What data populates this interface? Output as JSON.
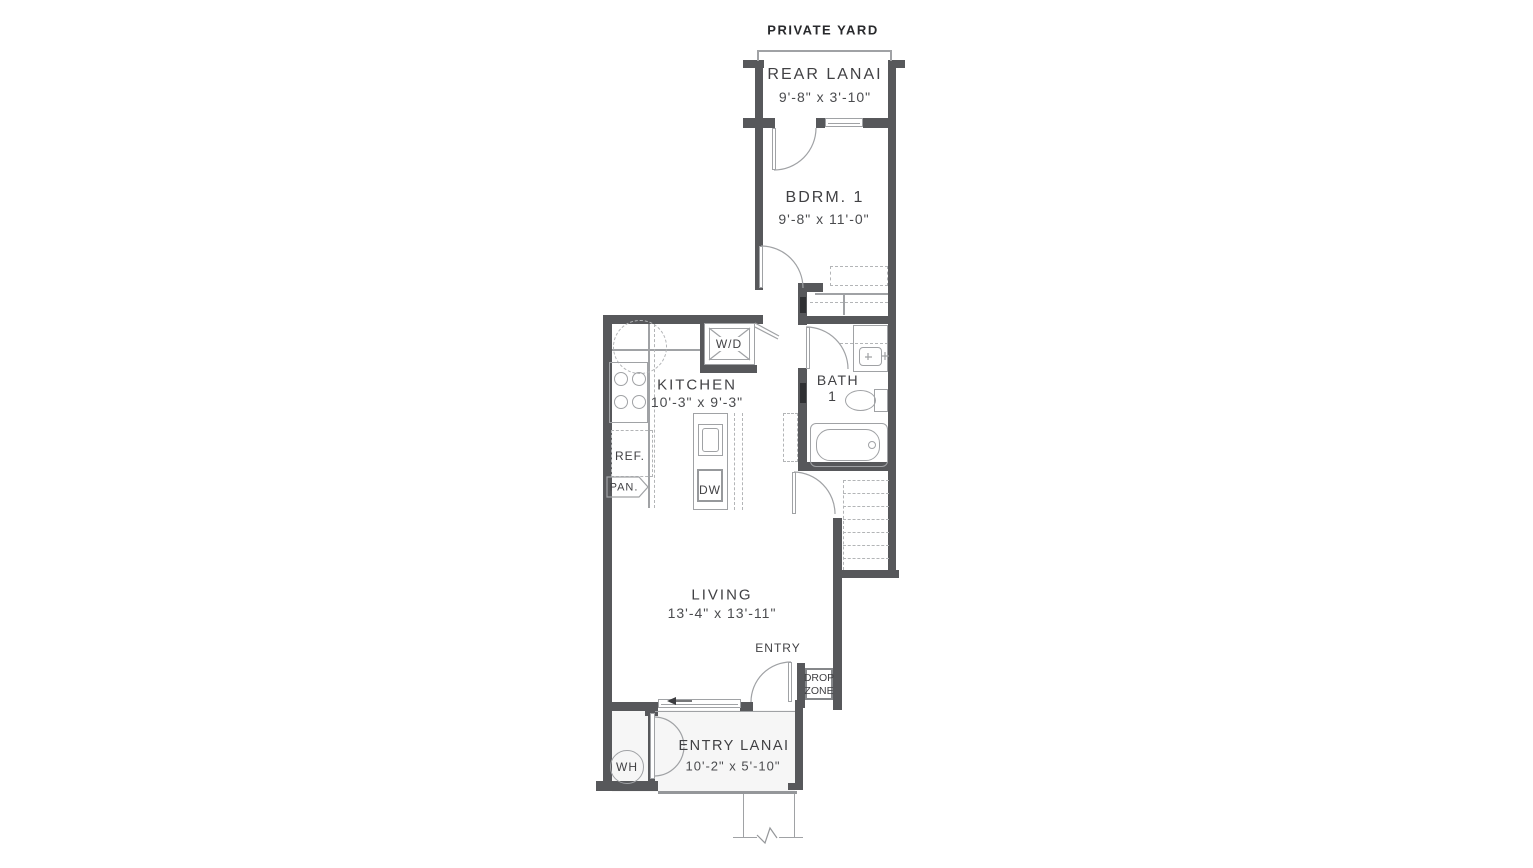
{
  "plan": {
    "yard_label": "PRIVATE YARD",
    "rooms": {
      "rear_lanai": {
        "name": "REAR LANAI",
        "dims": "9'-8\" x 3'-10\""
      },
      "bedroom1": {
        "name": "BDRM. 1",
        "dims": "9'-8\" x 11'-0\""
      },
      "kitchen": {
        "name": "KITCHEN",
        "dims": "10'-3\" x 9'-3\""
      },
      "bath1": {
        "name": "BATH",
        "number": "1"
      },
      "living": {
        "name": "LIVING",
        "dims": "13'-4\" x 13'-11\""
      },
      "entry": {
        "name": "ENTRY"
      },
      "drop_zone": {
        "line1": "DROP",
        "line2": "ZONE"
      },
      "entry_lanai": {
        "name": "ENTRY LANAI",
        "dims": "10'-2\" x 5'-10\""
      }
    },
    "fixtures": {
      "washer_dryer": "W/D",
      "refrigerator": "REF.",
      "pantry": "PAN.",
      "dishwasher": "DW",
      "water_heater": "WH"
    },
    "colors": {
      "wall": "#57585b",
      "line": "#a0a2a5",
      "dash": "#b3b5b7",
      "text": "#414144"
    }
  }
}
